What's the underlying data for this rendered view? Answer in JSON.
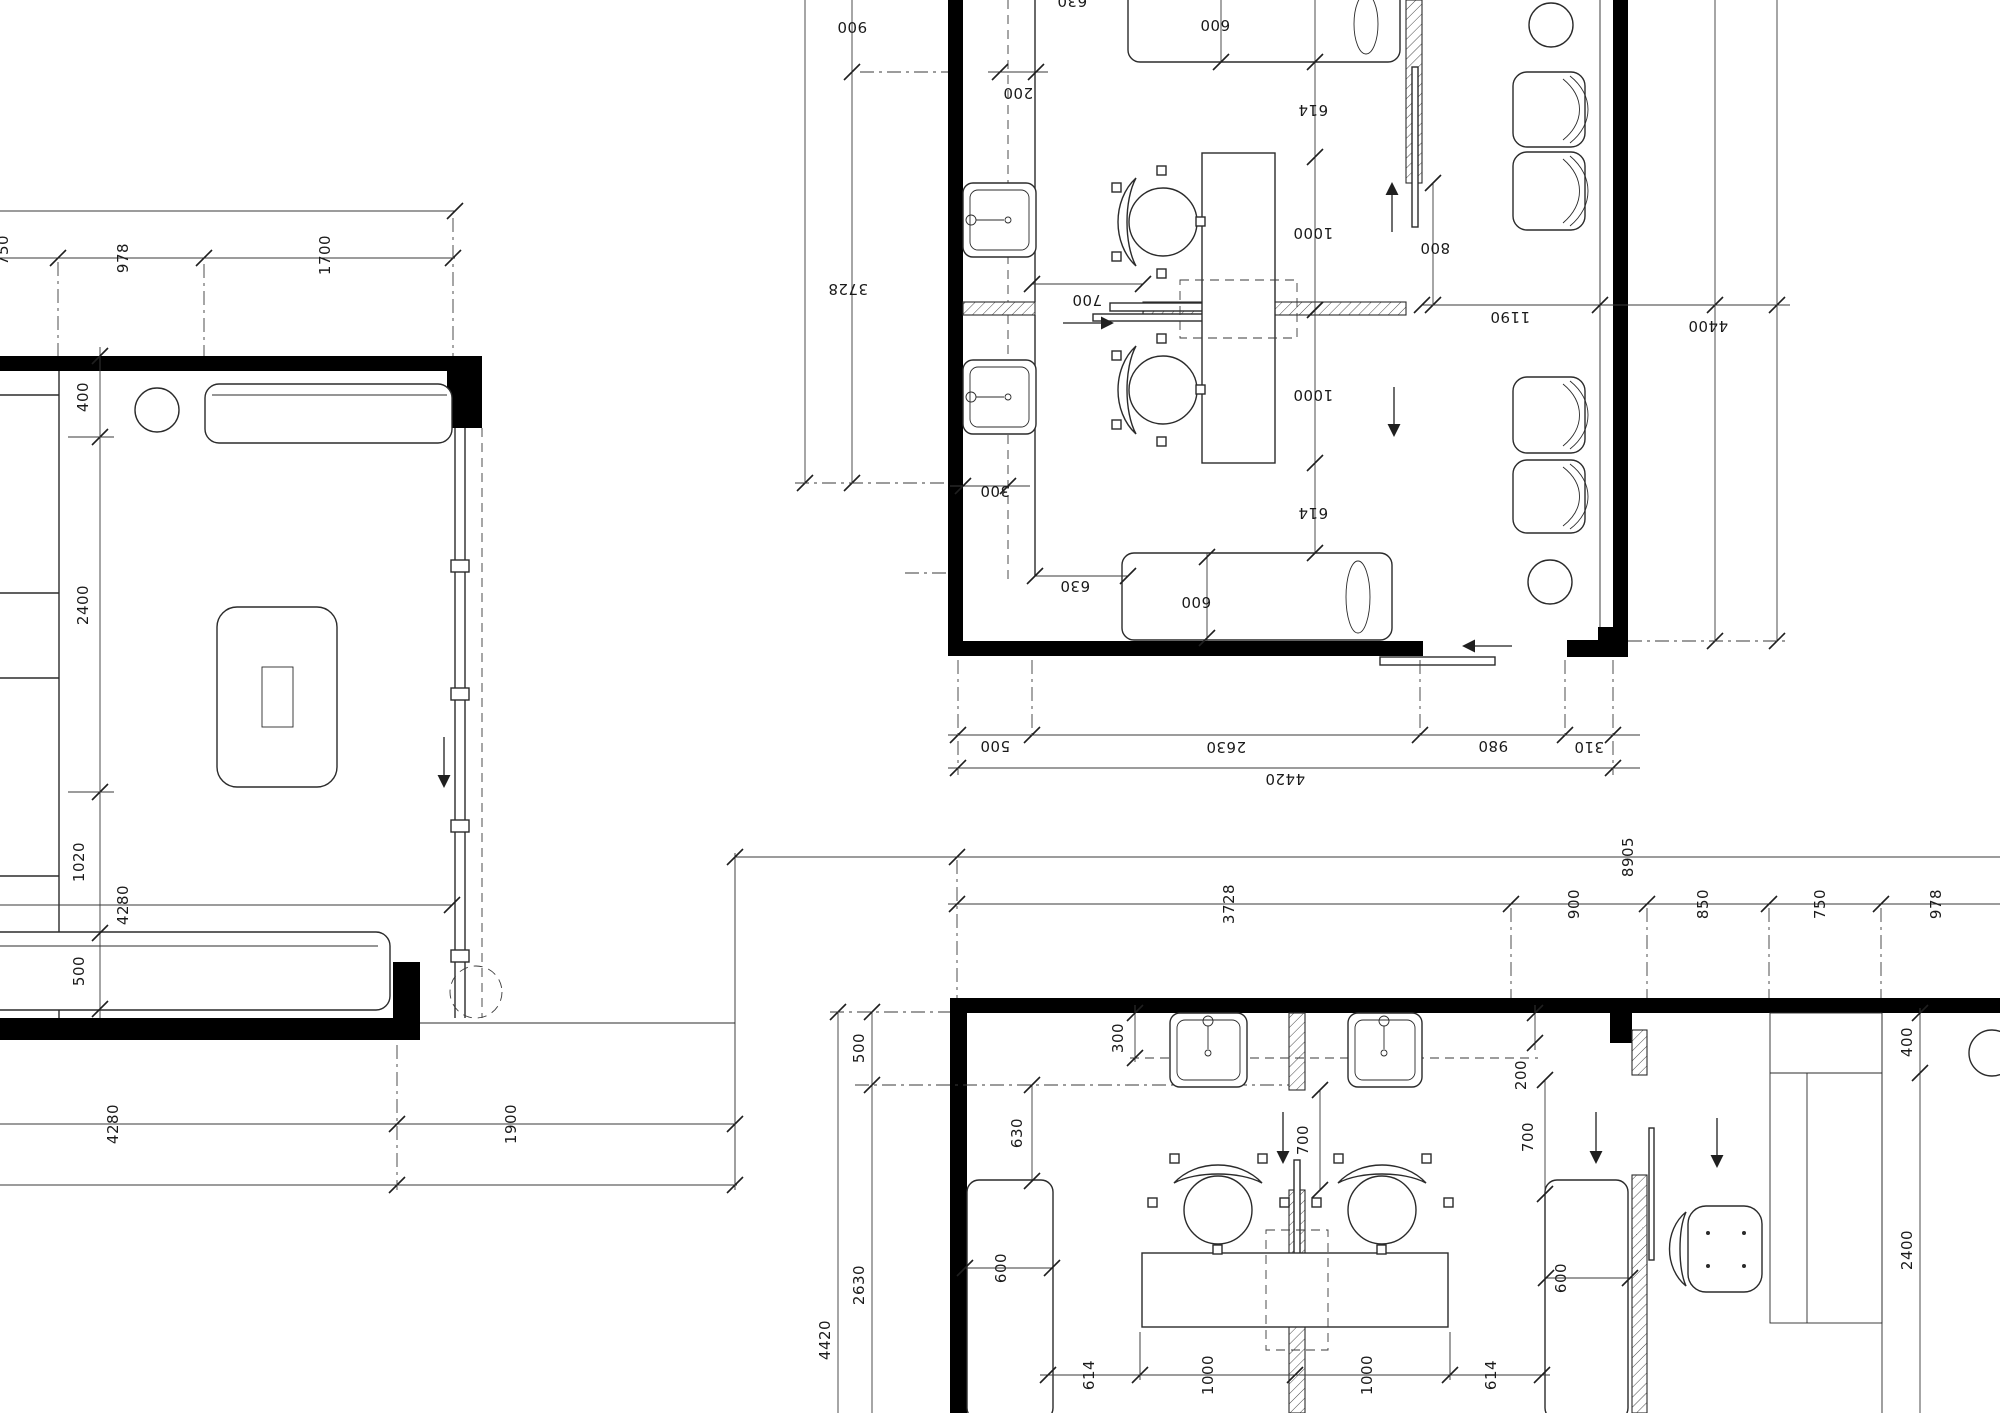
{
  "document": {
    "type": "architectural floor plan working drawing",
    "units": "mm",
    "background_color": "#ffffff",
    "wall_color": "#000000",
    "line_color": "#2b2b2b",
    "text_color": "#1a1a1a"
  },
  "plans": {
    "left_room": {
      "name": "room plan – left (cut at sheet edge)",
      "top_dims": [
        "750",
        "978",
        "1700"
      ],
      "left_dims": [
        "400",
        "2400",
        "1020",
        "500"
      ],
      "width_dim": "4280",
      "bottom_dims": [
        "4280",
        "1900"
      ]
    },
    "suite_rotated": {
      "name": "twin treatment suite – rotated 180°",
      "left_dims": [
        "900",
        "3728"
      ],
      "top_clip_dim": "630",
      "counter_dims": [
        "200",
        "300"
      ],
      "sofa_dims": [
        "600",
        "600",
        "630"
      ],
      "desk_dims": [
        "614",
        "1000",
        "1000",
        "614"
      ],
      "door_dims": [
        "700",
        "800",
        "1190"
      ],
      "right_dim": "4400",
      "bottom_dims": [
        "500",
        "2630",
        "980",
        "310",
        "4420"
      ]
    },
    "suite_bottom": {
      "name": "twin treatment suite with reception – bottom",
      "top_dims": [
        "8905",
        "3728",
        "900",
        "850",
        "750",
        "978"
      ],
      "left_dims": [
        "500",
        "2630",
        "4420"
      ],
      "counter_dims": [
        "300",
        "200"
      ],
      "interior_dims": [
        "630",
        "600",
        "700",
        "700",
        "600"
      ],
      "bottom_dims": [
        "614",
        "1000",
        "1000",
        "614"
      ],
      "right_dims": [
        "400",
        "2400"
      ]
    }
  }
}
